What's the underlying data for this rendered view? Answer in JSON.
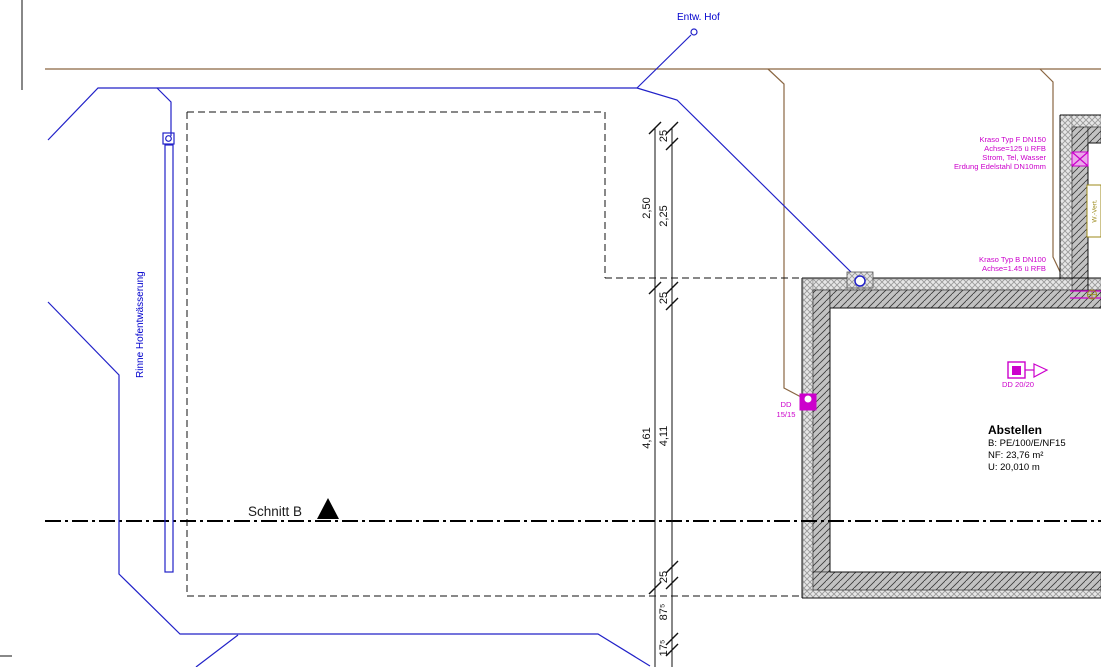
{
  "sheet": {
    "labels": {
      "entw_hof": "Entw. Hof",
      "rinne": "Rinne Hofentwässerung",
      "schnitt": "Schnitt B",
      "w_vert": "W.-Vert."
    },
    "annotations": {
      "kraso_f": [
        "Kraso Typ F DN150",
        "Achse=125 ü RFB",
        "Strom, Tel, Wasser",
        "Erdung Edelstahl DN10mm"
      ],
      "kraso_b": [
        "Kraso Typ B DN100",
        "Achse=1.45 ü RFB"
      ],
      "dd_15": [
        "DD",
        "15/15"
      ],
      "dd_20": "DD 20/20"
    },
    "room": {
      "name": "Abstellen",
      "line1": "B: PE/100/E/NF15",
      "line2": "NF: 23,76 m²",
      "line3": "U: 20,010 m"
    },
    "dimensions": {
      "left": [
        "2,50",
        "4,61"
      ],
      "right": [
        "25",
        "2,25",
        "25",
        "4,11",
        "25",
        "87⁵",
        "17⁵"
      ]
    },
    "colors": {
      "line_blue": "#2121c8",
      "text_blue": "#0000cd",
      "magenta": "#cc00cc",
      "brown": "#8a6642",
      "olive": "#9c8a1a",
      "hatch_concrete_bg": "#c2c2c2",
      "hatch_insulation_bg": "#e6e6e6"
    }
  }
}
